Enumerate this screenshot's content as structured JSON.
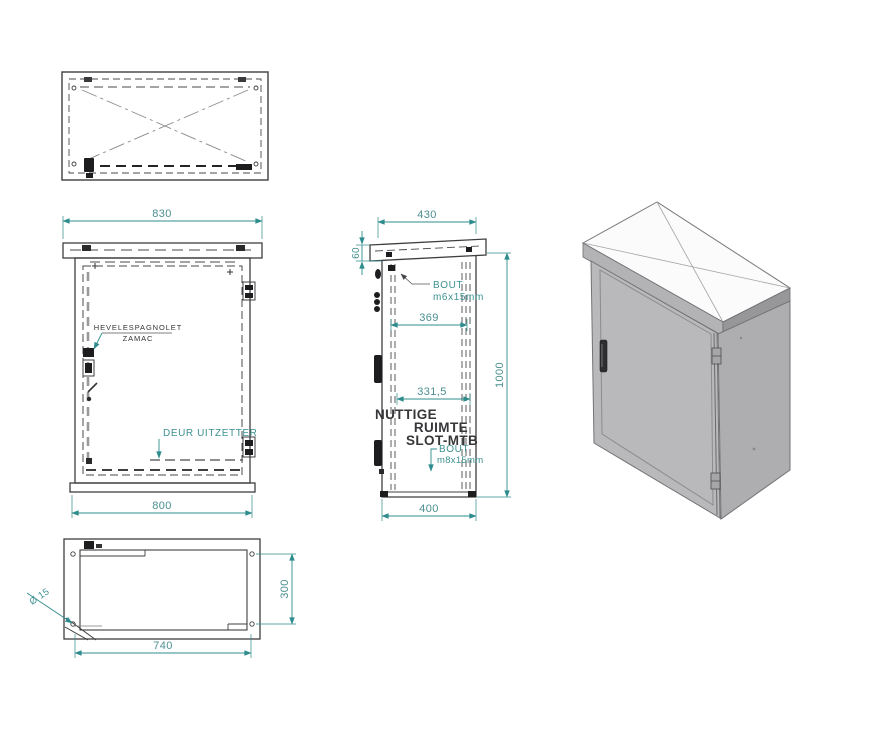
{
  "front_view": {
    "dim_top": "830",
    "dim_bottom": "800",
    "latch_label_1": "HEVELESPAGNOLET",
    "latch_label_2": "ZAMAC",
    "door_stay_label": "DEUR UITZETTER"
  },
  "side_view": {
    "dim_top": "430",
    "dim_roof": "60",
    "dim_inner": "369",
    "dim_slot": "331,5",
    "dim_height": "1000",
    "dim_bottom": "400",
    "bolt_top_1": "BOUT",
    "bolt_top_2": "m6x15mm",
    "space_1": "NUTTIGE",
    "space_2": "RUIMTE",
    "space_3": "SLOT-MTB",
    "bolt_bottom_1": "BOUT",
    "bolt_bottom_2": "m8x15mm"
  },
  "bottom_view": {
    "dim_width": "740",
    "dim_height": "300",
    "hole_label": "Ø 15"
  },
  "colors": {
    "dimension_accent": "#2e8c8c",
    "drawing_line": "#3f3f41",
    "iso_body_gray": "#b4b4b6"
  }
}
